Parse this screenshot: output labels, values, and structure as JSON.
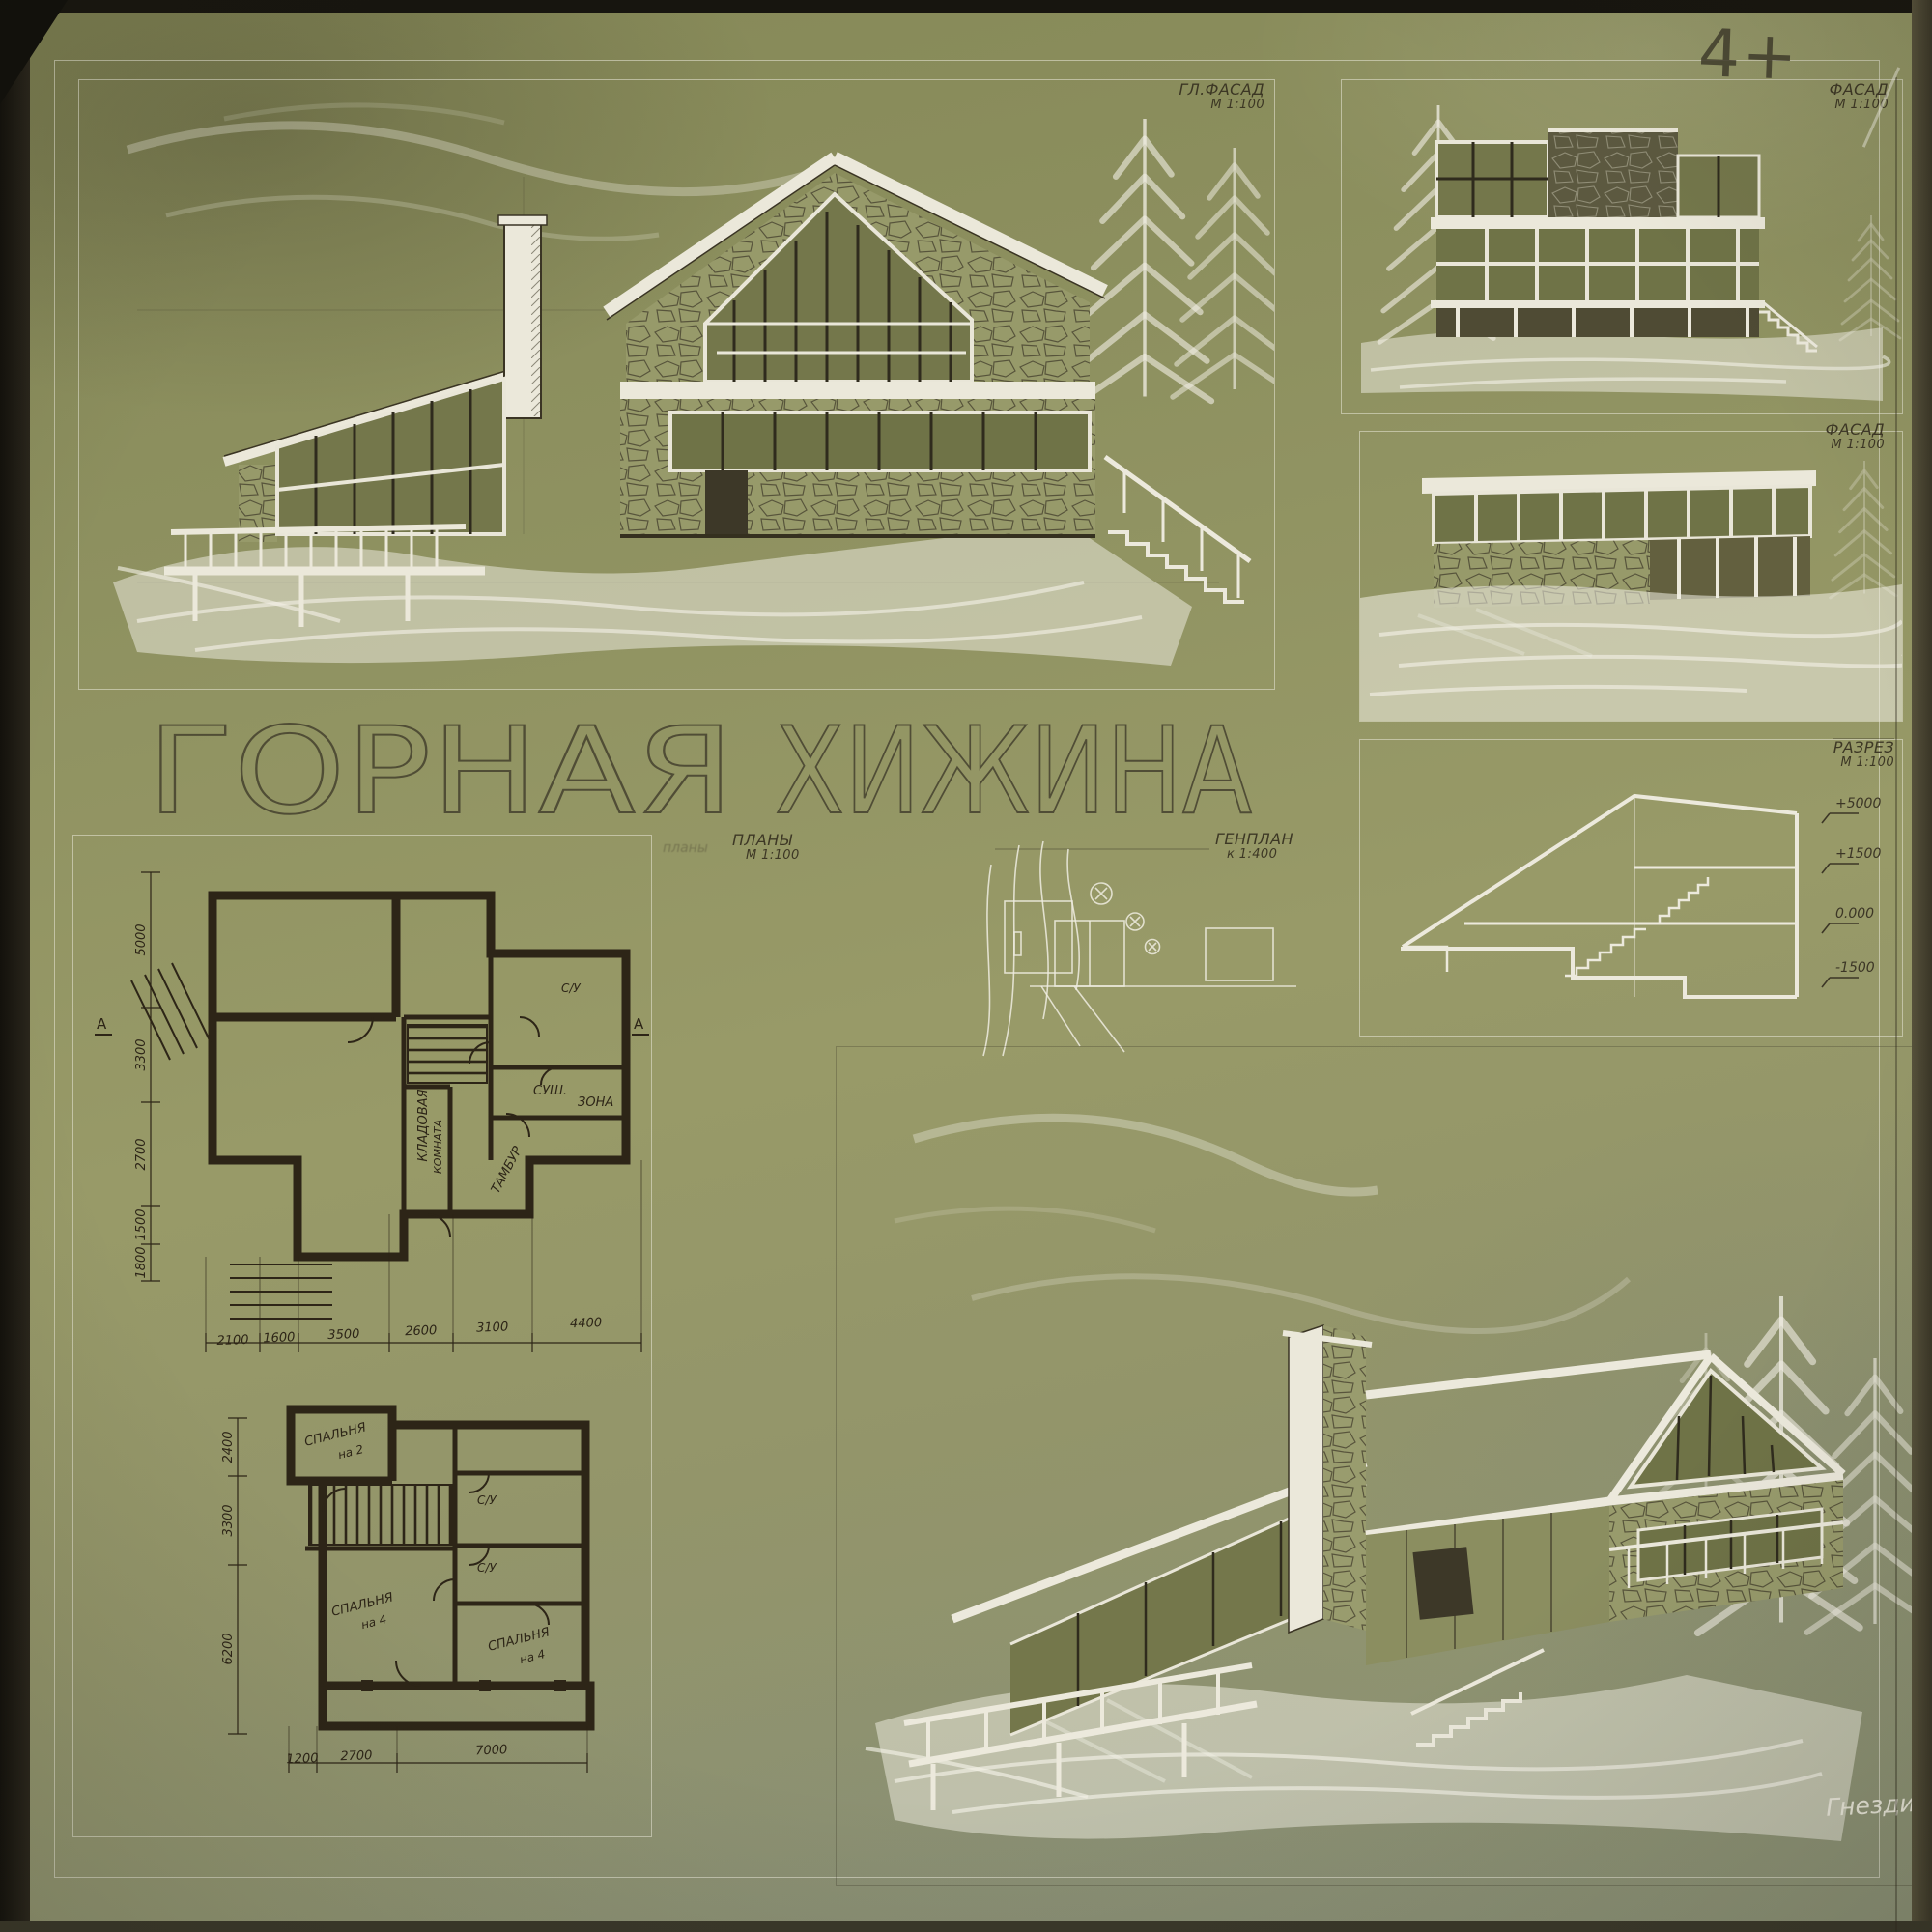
{
  "meta": {
    "grade": "4+",
    "signature": "Гнездилова АЕ 2-DA",
    "title_words": [
      "ГОРНАЯ",
      "ХИЖИНА"
    ]
  },
  "panels": {
    "main_facade": {
      "name": "ГЛ.ФАСАД",
      "scale": "М 1:100"
    },
    "side_facade": {
      "name": "ФАСАД",
      "scale": "М 1:100"
    },
    "rear_facade": {
      "name": "ФАСАД",
      "scale": "М 1:100"
    },
    "section": {
      "name": "РАЗРЕЗ",
      "scale": "М 1:100",
      "marks": [
        "+5000",
        "+1500",
        "0.000",
        "-1500"
      ]
    },
    "plans": {
      "name": "ПЛАНЫ",
      "scale": "М 1:100",
      "pencil_note": "планы",
      "floor1": {
        "rooms": {
          "storage1": "КЛАДОВАЯ",
          "storage2": "КОМНАТА",
          "tambour": "ТАМБУР",
          "wc": "С/У",
          "drying1": "СУШ.",
          "drying2": "ЗОНА"
        },
        "dims_bottom": [
          "2100",
          "1600",
          "3500",
          "2600",
          "3100",
          "4400"
        ],
        "dims_left": [
          "5000",
          "3300",
          "2700",
          "1500",
          "1800"
        ],
        "section_mark": "А"
      },
      "floor2": {
        "rooms": {
          "bed2a": "СПАЛЬНЯ",
          "bed2b": "на 2",
          "wc1": "С/У",
          "wc2": "С/У",
          "bed4a1": "СПАЛЬНЯ",
          "bed4a2": "на 4",
          "bed4b1": "СПАЛЬНЯ",
          "bed4b2": "на 4"
        },
        "dims_bottom": [
          "1200",
          "2700",
          "7000"
        ],
        "dims_left": [
          "2400",
          "3300",
          "6200"
        ]
      }
    },
    "siteplan": {
      "name": "ГЕНПЛАН",
      "scale": "к 1:400"
    }
  }
}
